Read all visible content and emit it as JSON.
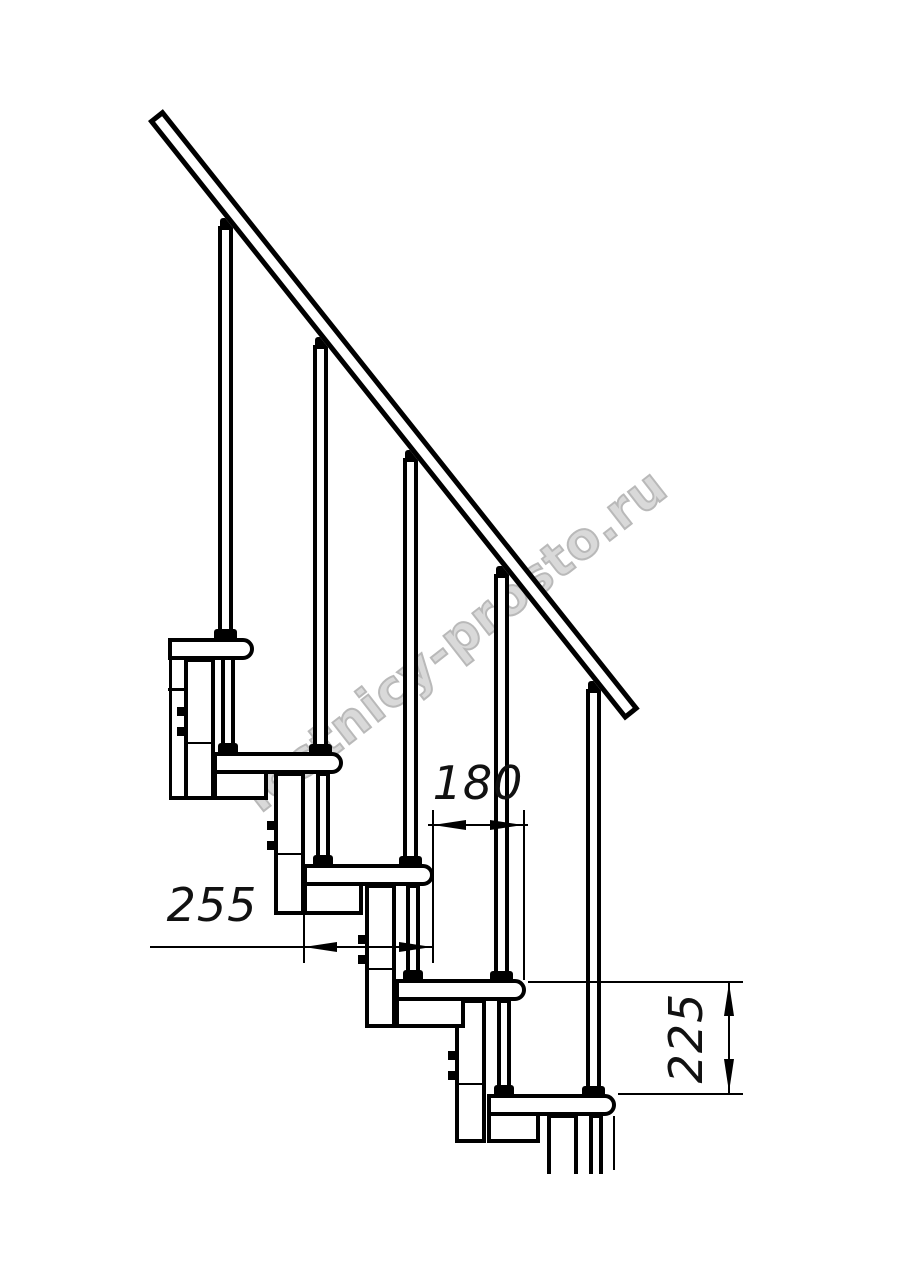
{
  "drawing": {
    "type": "technical side-view drawing of a modular staircase section",
    "watermark_text": "lestnicy-prosto.ru",
    "background_color": "#ffffff",
    "line_color": "#000000",
    "watermark_color": "#b9b9b9",
    "components": {
      "handrail_count": 1,
      "baluster_count": 5,
      "tread_count": 5,
      "support_column_count": 5
    },
    "dimensions": [
      {
        "id": "d180",
        "label": "180",
        "orientation": "horizontal",
        "meaning": "step run between tread noses"
      },
      {
        "id": "d255",
        "label": "255",
        "orientation": "horizontal",
        "meaning": "tread depth"
      },
      {
        "id": "d225",
        "label": "225",
        "orientation": "vertical",
        "meaning": "riser height between treads"
      }
    ]
  }
}
